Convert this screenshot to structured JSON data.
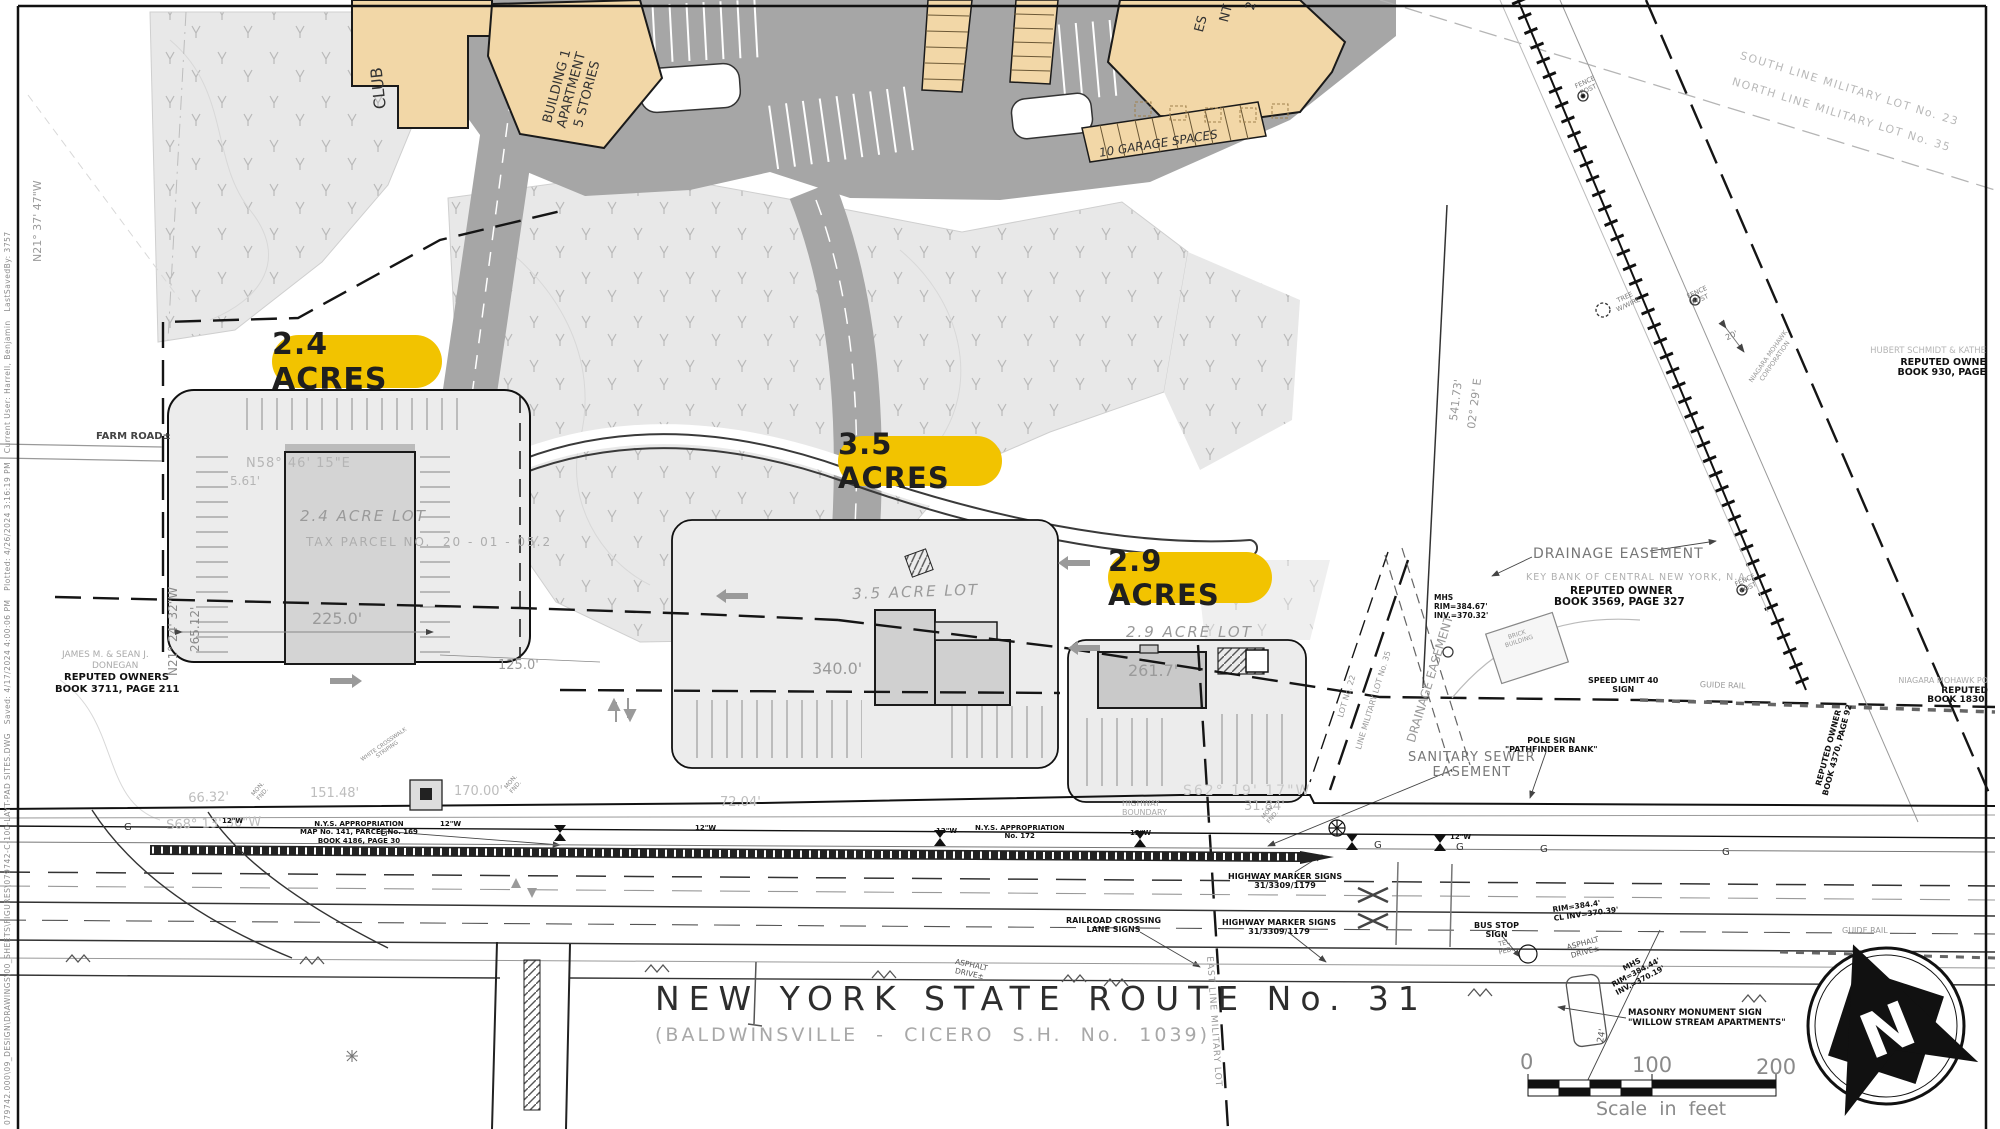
{
  "colors": {
    "accent_yellow": "#F2C300",
    "building_tan": "#F2D7A7",
    "road_gray": "#A6A6A6",
    "line_dark": "#111111"
  },
  "badges": {
    "lot24": "2.4 ACRES",
    "lot35": "3.5 ACRES",
    "lot29": "2.9 ACRES"
  },
  "title": {
    "route": "NEW YORK STATE ROUTE No. 31",
    "subtitle": "(BALDWINSVILLE  -  CICERO  S.H.  No.  1039)"
  },
  "scale_bar": {
    "ticks": [
      "0",
      "100",
      "200"
    ],
    "caption": "Scale  in  feet"
  },
  "north_arrow": {
    "letter": "N"
  },
  "plot_stamp": "079742.000\\09_DESIGN\\DRAWINGS\\00_SHEETS\\FIGURES\\079742-C-100-LAYT-PAD SITES.DWG   Saved: 4/17/2024 4:00:06 PM   Plotted: 4/26/2024 3:16:19 PM   Current User: Harrell, Benjamin   LastSavedBy: 3757",
  "labels": {
    "farm_road": "FARM ROAD±",
    "club": "CLUB",
    "b1": "BUILDING 1\nAPARTMENT\n5 STORIES",
    "b2_1": "2",
    "b2_2": "NT",
    "b2_3": "ES",
    "garages": "10 GARAGE SPACES",
    "lot24": "2.4 ACRE LOT",
    "lot24_parcel": "TAX PARCEL NO.  20 - 01 - 05.2",
    "lot35": "3.5 ACRE LOT",
    "lot29": "2.9 ACRE LOT",
    "d225": "225.0'",
    "d340": "340.0'",
    "d2617": "261.7'",
    "d125": "125.0'",
    "brg_n5846": "N58° 46' 15\"E",
    "d561": "5.61'",
    "brg_n2124": "N21° 24' 32\"W",
    "d26512": "265.12'",
    "brg_n2137": "N21° 37' 47\"W",
    "don1": "JAMES M. & SEAN J.",
    "don2": "DONEGAN",
    "don3": "REPUTED OWNERS",
    "don4": "BOOK 3711, PAGE 211",
    "d6632": "66.32'",
    "d15148": "151.48'",
    "brg_s6813": "S68° 13' 30\"W",
    "d170": "170.00'",
    "d7204": "72.04'",
    "nys1": "N.Y.S. APPROPRIATION\nMAP No. 141, PARCEL No. 169\nBOOK 4186, PAGE 30",
    "nys2": "N.Y.S. APPROPRIATION\nNo. 172",
    "hwy_bnd": "HIGHWAY\nBOUNDARY",
    "brg_s6219": "S62° 19' 17\"W",
    "d3184": "31.84'",
    "mon_fnd": "MON.\nFND.",
    "marker_signs": "HIGHWAY MARKER SIGNS\n31/3309/1179",
    "rr_signs": "RAILROAD CROSSING\nLANE SIGNS",
    "bus_stop": "BUS STOP\nSIGN",
    "speed": "SPEED LIMIT 40\nSIGN",
    "guide_rail": "GUIDE RAIL",
    "pole_sign": "POLE SIGN\n\"PATHFINDER BANK\"",
    "san_sewer": "SANITARY SEWER\nEASEMENT",
    "drain_ease": "DRAINAGE EASEMENT",
    "keybank1": "KEY BANK OF CENTRAL NEW YORK, N.A.",
    "keybank2": "REPUTED OWNER",
    "keybank3": "BOOK 3569, PAGE 327",
    "fence_post": "FENCE\nPOST",
    "tree_wire": "TREE\nW/WIRE",
    "d20": "20'",
    "niagara_rot": "NIAGARA MOHAWK\nCORPORATION",
    "schmidt1": "HUBERT SCHMIDT & KATHE",
    "schmidt2": "REPUTED OWNE",
    "schmidt3": "BOOK 930, PAGE",
    "south_line": "SOUTH LINE MILITARY LOT No. 23",
    "north_line": "NORTH LINE MILITARY LOT No. 35",
    "niagara1": "NIAGARA MOHAWK PO",
    "niagara2": "REPUTED",
    "niagara3": "BOOK 1830,",
    "rep4370": "REPUTED OWNER\nBOOK 4370, PAGE 92",
    "mil35": "LINE MILITARY LOT No. 35",
    "mil22": "LOT No. 22",
    "east_line": "EAST LINE MILITARY LOT",
    "d54173": "541.73'",
    "brg0229": "02° 29' E",
    "mhs_n": "MHS\nRIM=384.67'\nINV.=370.32'",
    "mhs_s": "MHS\nRIM=384.44'\nINV.=370.19'",
    "mh_cl": "RIM=384.4'\nCL INV=370.39'",
    "masonry": "MASONRY MONUMENT SIGN\n\"WILLOW STREAM APARTMENTS\"",
    "asphalt": "ASPHALT\nDRIVE±",
    "tel_ped": "TEL\nPED.",
    "d24": "24'",
    "crosswalk": "WHITE CROSSWALK\nSTRIPING",
    "brick": "BRICK\nBUILDING",
    "w12": "12\"W",
    "g": "G"
  }
}
